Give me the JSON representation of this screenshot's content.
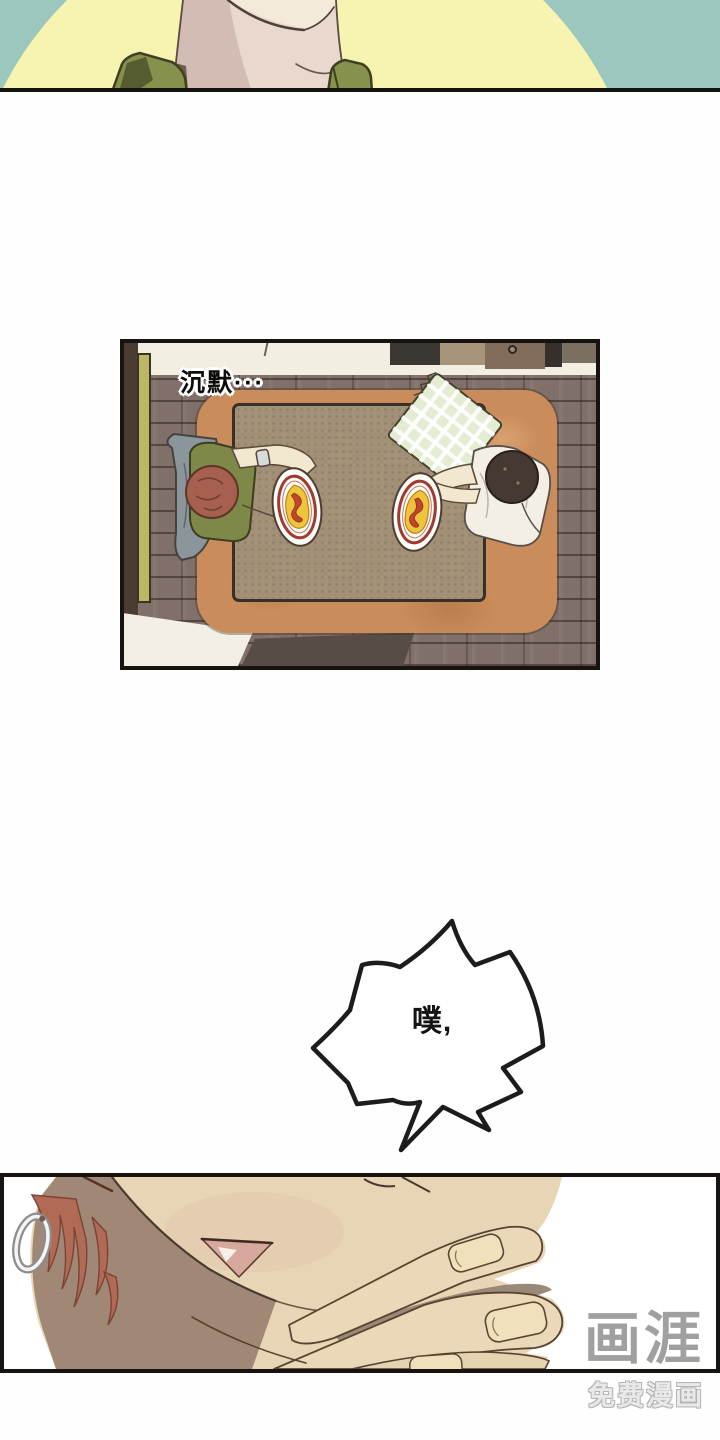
{
  "page": {
    "width": 720,
    "height": 1440,
    "background": "#fefefe"
  },
  "panel_top": {
    "description": "neck and shoulders of person in green shirt before yellow circle",
    "background_teal": "#9cc7be",
    "circle_yellow": "#f7f3b0",
    "skin": "#e9d8ce",
    "skin_shadow": "#d2bcb4",
    "shirt_green": "#87914e",
    "shirt_green_dark": "#555c2f"
  },
  "panel_dining": {
    "caption": "沉默···",
    "floor": "#81706a",
    "wall": "#f2eee1",
    "left_wall_accent": "#bcb765",
    "rug": "#cb8c5b",
    "table": "#a29077",
    "mat_dark": "#574d46",
    "left_person": {
      "hair": "#a7604f",
      "sweater": "#7d8849",
      "jacket": "#8b959c"
    },
    "right_person": {
      "hair": "#463931",
      "shirt": "#f3efe5",
      "blanket": "#e4ecd3"
    },
    "plate": {
      "rim": "#fdfcf6",
      "ring": "#a13a30",
      "egg": "#eec43e",
      "sauce": "#c1452c"
    }
  },
  "speech_burst": {
    "text": "噗,",
    "fill": "#ffffff",
    "stroke": "#1c1c1c"
  },
  "panel_closeup": {
    "description": "close-up of chin covered by hand, hoop earring and red hair at left",
    "skin": "#e7d5b5",
    "shadow": "#a18876",
    "hair": "#b06a55",
    "mouth": "#d8a89e",
    "nail": "#f0e0bc",
    "line": "#57432f"
  },
  "watermark": {
    "logo": "画涯",
    "tagline": "免费漫画",
    "logo_color": "#9b9b9b",
    "tagline_color": "#e9e9e9"
  }
}
